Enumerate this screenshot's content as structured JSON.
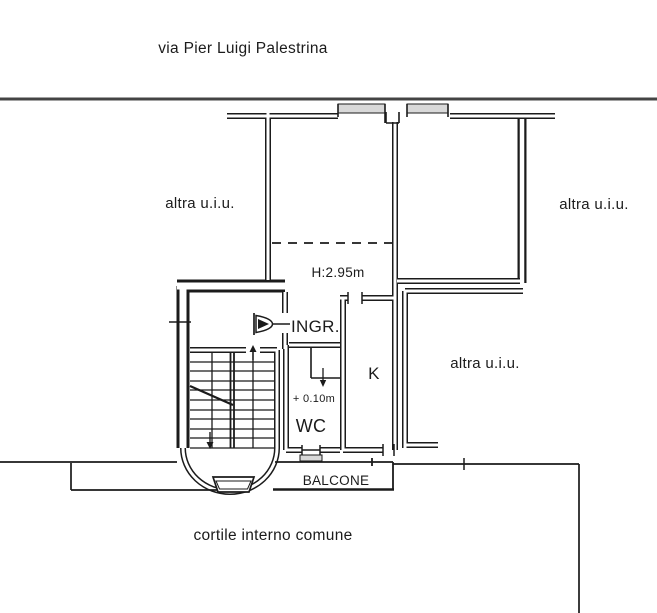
{
  "document": {
    "type": "cadastral-floor-plan",
    "street_label": "via Pier Luigi Palestrina",
    "courtyard_label": "cortile interno comune"
  },
  "rooms": {
    "entrance": "INGR.",
    "kitchen": "K",
    "wc": "WC",
    "balcony": "BALCONE"
  },
  "annotations": {
    "ceiling_height": "H:2.95m",
    "level_offset": "+ 0.10m",
    "other_unit_top_left": "altra u.i.u.",
    "other_unit_top_right": "altra u.i.u.",
    "other_unit_mid_right": "altra u.i.u."
  },
  "colors": {
    "line": "#1b1b1b",
    "street_line": "#444444",
    "window_fill": "#d9d9d9",
    "background": "#ffffff"
  }
}
